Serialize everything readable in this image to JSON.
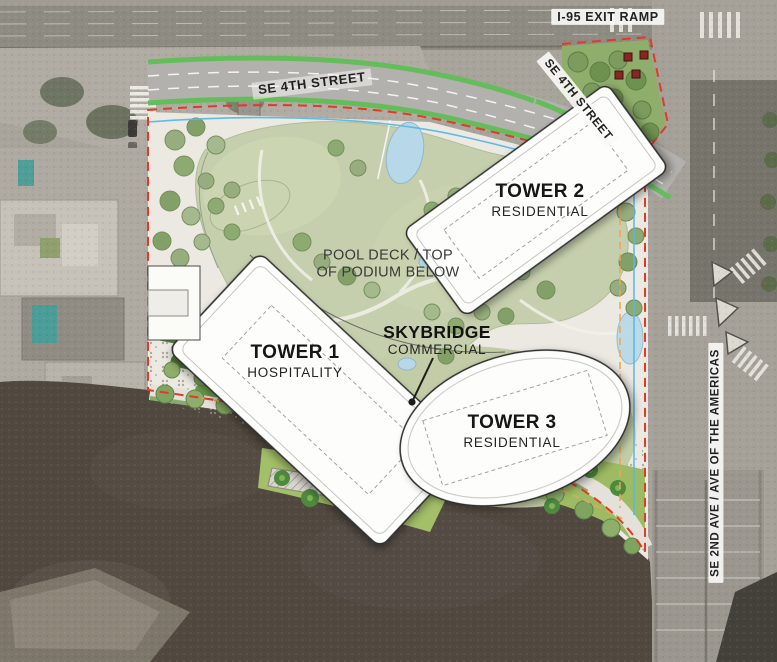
{
  "map": {
    "streets": {
      "i95_exit_ramp": "I-95 EXIT RAMP",
      "se_4th_street_west": "SE 4TH STREET",
      "se_4th_street_east": "SE 4TH STREET",
      "se_2nd_ave": "SE 2ND AVE / AVE OF THE AMERICAS"
    },
    "towers": [
      {
        "name": "TOWER 1",
        "use": "HOSPITALITY"
      },
      {
        "name": "TOWER 2",
        "use": "RESIDENTIAL"
      },
      {
        "name": "TOWER 3",
        "use": "RESIDENTIAL"
      }
    ],
    "annotations": {
      "pool_deck_line1": "POOL DECK / TOP",
      "pool_deck_line2": "OF PODIUM BELOW",
      "skybridge_name": "SKYBRIDGE",
      "skybridge_use": "COMMERCIAL"
    },
    "legend_colors": {
      "property_line_red": "#e23a28",
      "setback_blue": "#59b7e6",
      "setback_orange": "#e7a758",
      "street_landscape_green": "#64bd5a",
      "pool_water": "#b7d8e8",
      "river_water": "#51493f"
    }
  }
}
